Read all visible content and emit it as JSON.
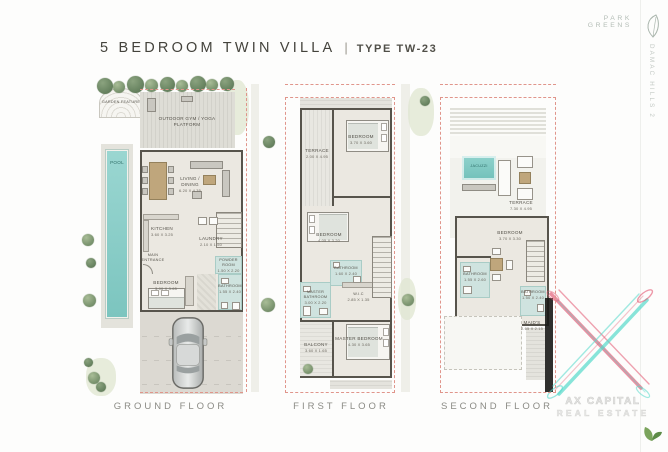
{
  "header": {
    "title": "5 BEDROOM TWIN VILLA",
    "divider": "|",
    "type_label": "TYPE TW-23",
    "brand": "PARK GREENS",
    "side_text": "DAMAC HILLS 2"
  },
  "colors": {
    "boundary_dash": "#e0958b",
    "pool_teal": "#8fd0cb",
    "wall": "#57544c",
    "watermark_red": "#e25570",
    "watermark_teal": "#55d8cb"
  },
  "floors": {
    "ground": {
      "name": "GROUND FLOOR",
      "rooms": {
        "garden_feature": {
          "label": "GARDEN FEATURE"
        },
        "outdoor_gym": {
          "label": "OUTDOOR GYM / YOGA PLATFORM"
        },
        "pool": {
          "label": "POOL"
        },
        "living_dining": {
          "label": "LIVING / DINING",
          "dims": "6.20 X 4.35"
        },
        "kitchen": {
          "label": "KITCHEN",
          "dims": "3.60 X 3.25"
        },
        "laundry": {
          "label": "LAUNDRY",
          "dims": "2.10 X 1.50"
        },
        "powder": {
          "label": "POWDER ROOM",
          "dims": "1.50 X 2.20"
        },
        "entrance": {
          "label": "MAIN ENTRANCE"
        },
        "bedroom": {
          "label": "BEDROOM",
          "dims": "3.00 X 3.65"
        },
        "bathroom": {
          "label": "BATHROOM",
          "dims": "1.55 X 2.40"
        }
      }
    },
    "first": {
      "name": "FIRST FLOOR",
      "rooms": {
        "terrace": {
          "label": "TERRACE",
          "dims": "2.00 X 4.95"
        },
        "bedroom2": {
          "label": "BEDROOM",
          "dims": "3.70 X 3.60"
        },
        "bedroom3": {
          "label": "BEDROOM",
          "dims": "4.05 X 3.20"
        },
        "bathroom": {
          "label": "BATHROOM",
          "dims": "1.60 X 2.40"
        },
        "master_bath": {
          "label": "MASTER BATHROOM",
          "dims": "3.00 X 2.20"
        },
        "wic": {
          "label": "W.I.C",
          "dims": "2.85 X 1.35"
        },
        "balcony": {
          "label": "BALCONY",
          "dims": "3.60 X 1.65"
        },
        "master_bedroom": {
          "label": "MASTER BEDROOM",
          "dims": "4.30 X 3.65"
        }
      }
    },
    "second": {
      "name": "SECOND FLOOR",
      "rooms": {
        "jacuzzi": {
          "label": "JACUZZI"
        },
        "terrace": {
          "label": "TERRACE",
          "dims": "7.30 X 4.95"
        },
        "bedroom5": {
          "label": "BEDROOM",
          "dims": "3.70 X 3.30"
        },
        "bathroom_left": {
          "label": "BATHROOM",
          "dims": "1.55 X 2.60"
        },
        "bathroom_right": {
          "label": "BATHROOM",
          "dims": "1.50 X 2.40"
        },
        "maids": {
          "label": "MAID'S",
          "dims": "2.65 X 2.15"
        }
      }
    }
  },
  "watermark": {
    "line1": "AX CAPITAL",
    "line2": "REAL ESTATE"
  }
}
